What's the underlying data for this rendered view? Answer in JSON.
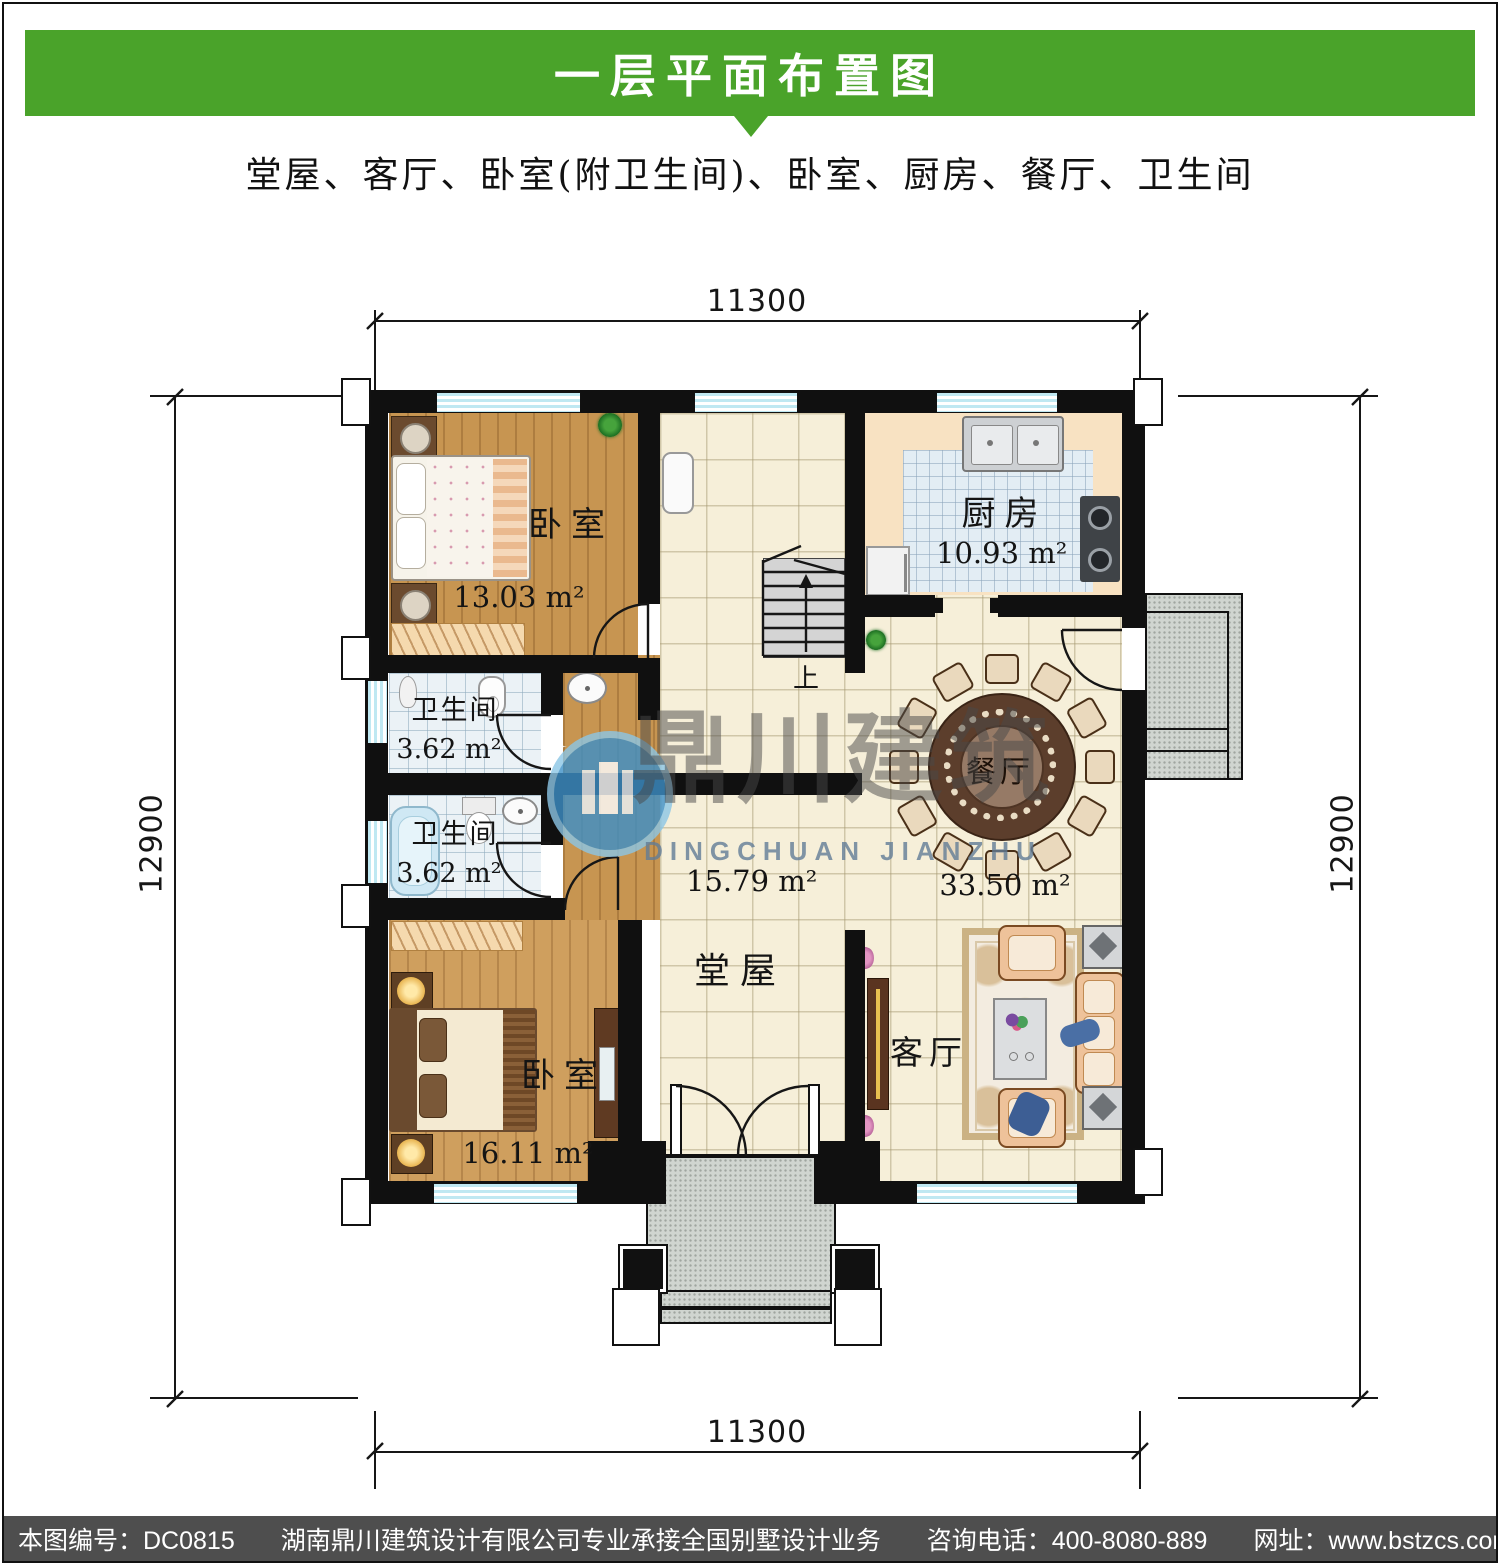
{
  "header": {
    "title": "一层平面布置图",
    "subtitle": "堂屋、客厅、卧室(附卫生间)、卧室、厨房、餐厅、卫生间"
  },
  "dimensions": {
    "top": "11300",
    "bottom": "11300",
    "left": "12900",
    "right": "12900"
  },
  "rooms": {
    "bedroom1": {
      "name": "卧室",
      "area": "13.03 m²"
    },
    "bedroom2": {
      "name": "卧室",
      "area": "16.11 m²"
    },
    "bath1": {
      "name": "卫生间",
      "area": "3.62 m²"
    },
    "bath2": {
      "name": "卫生间",
      "area": "3.62 m²"
    },
    "kitchen": {
      "name": "厨房",
      "area": "10.93 m²"
    },
    "hall": {
      "name": "堂屋",
      "area": "15.79 m²"
    },
    "dining": {
      "name": "餐厅",
      "area": "33.50 m²"
    },
    "living": {
      "name": "客厅"
    }
  },
  "stairs": {
    "up_label": "上"
  },
  "watermark": {
    "cn": "鼎川建筑",
    "en": "DINGCHUAN JIANZHU"
  },
  "footer": {
    "code": "本图编号：DC0815",
    "company": "湖南鼎川建筑设计有限公司专业承接全国别墅设计业务",
    "phone": "咨询电话：400-8080-889",
    "website": "网址：www.bstzcs.com"
  },
  "colors": {
    "banner_green": "#4AA32A",
    "footer_gray": "#4E4E4E",
    "wall_black": "#101010",
    "window_blue": "#BFE8F2"
  }
}
